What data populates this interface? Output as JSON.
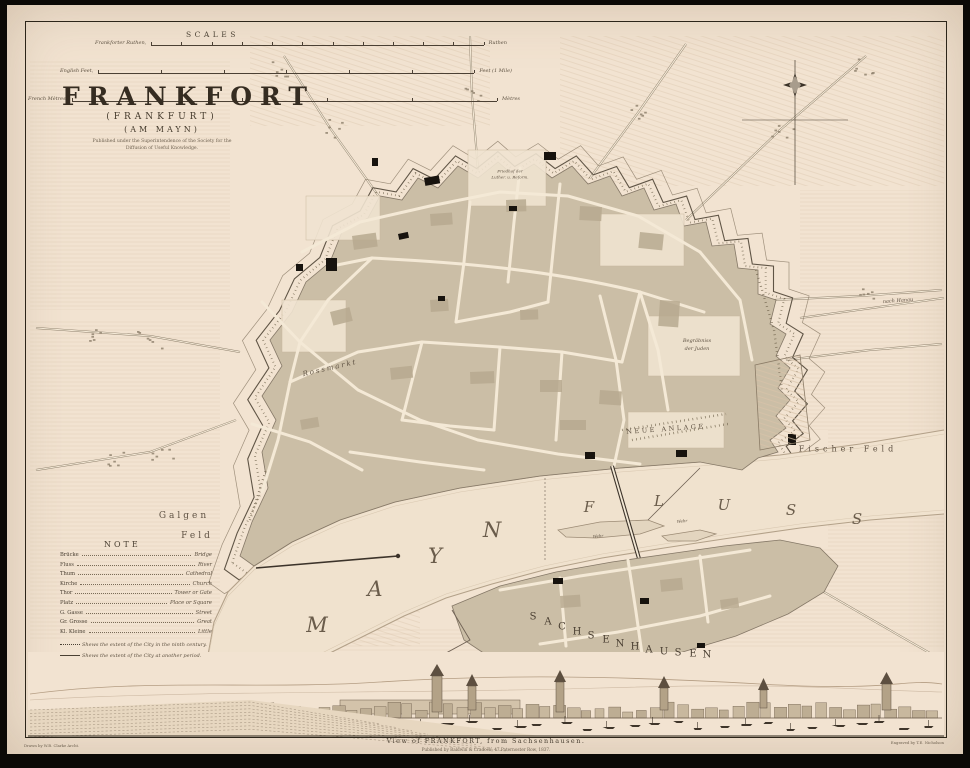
{
  "colors": {
    "paper": "#f2e3d1",
    "ink": "#3b3227",
    "ink_light": "#6e6150",
    "block_tan": "#cbbea6",
    "block_dark": "#b7a98f",
    "river": "#f0e2ce",
    "bank": "#b3a189",
    "black_building": "#17130e"
  },
  "scales": {
    "title": "SCALES",
    "rows": [
      {
        "left": "Frankforter Ruthen,",
        "right": "Ruthen"
      },
      {
        "left": "English Feet,",
        "right": "Feet (1 Mile)"
      },
      {
        "left": "French Mètres,",
        "right": "Mètres"
      }
    ]
  },
  "title_block": {
    "main": "FRANKFORT",
    "sub1": "(FRANKFURT)",
    "sub2": "(AM MAYN)",
    "imprint1": "Published under the Superintendence of the Society for the",
    "imprint2": "Diffusion of Useful Knowledge."
  },
  "note": {
    "title": "NOTE",
    "entries": [
      [
        "Brücke",
        "Bridge"
      ],
      [
        "Fluss",
        "River"
      ],
      [
        "Thum",
        "Cathedral"
      ],
      [
        "Kirche",
        "Church"
      ],
      [
        "Thor",
        "Tower or Gate"
      ],
      [
        "Platz",
        "Place or Square"
      ],
      [
        "G. Gasse",
        "Street"
      ],
      [
        "Gr. Grosse",
        "Great"
      ],
      [
        "Kl. Kleine",
        "Little"
      ]
    ],
    "dotted": "Shews the extent of the City in the ninth century.",
    "dashed": "Shews the extent of the City at another period."
  },
  "map_labels": {
    "mayn": "MAYN",
    "fluss": "FLUSS",
    "sachsenhausen": "SACHSENHAUSEN",
    "galgen1": "Galgen",
    "galgen2": "Feld",
    "fischer": "Fischer  Feld",
    "neue_anlage": "NEUE  ANLAGE",
    "juden1": "Begräbniss",
    "juden2": "der Juden",
    "rossmarkt": "Rossmarkt",
    "friedhof1": "Friedhof der",
    "friedhof2": "Luther. u. Reform.",
    "wehr": "Wehr",
    "nach_hanau": "nach Hanau"
  },
  "footer": {
    "caption": "View of FRANKFORT, from Sachsenhausen.",
    "imprint": "Published by Baldwin & Cradock, 47 Paternoster Row, 1837.",
    "drawn": "Drawn by W.B. Clarke Archt.",
    "engraved": "Engraved by T.E. Nicholson"
  }
}
